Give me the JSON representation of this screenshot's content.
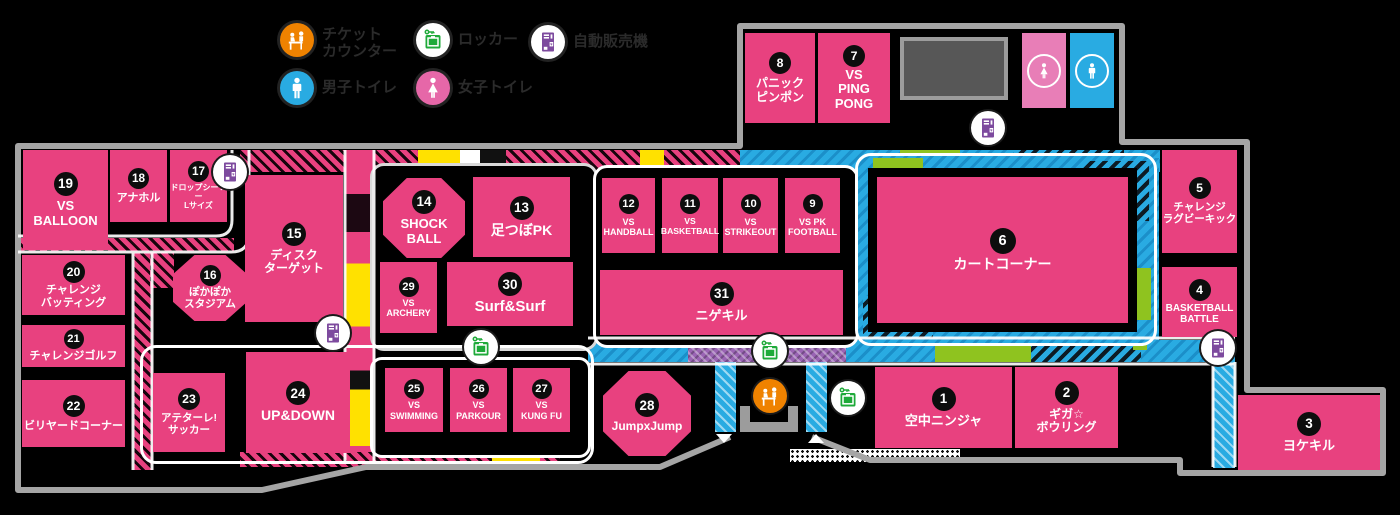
{
  "legend": {
    "items": [
      {
        "icon": "ticket-counter-icon",
        "label": "チケット\nカウンター",
        "color": "#ef8200"
      },
      {
        "icon": "locker-icon",
        "label": "ロッカー",
        "color": "#1eaa39"
      },
      {
        "icon": "vending-machine-icon",
        "label": "自動販売機",
        "color": "#7d4a9e"
      },
      {
        "icon": "mens-toilet-icon",
        "label": "男子トイレ",
        "color": "#29abe2"
      },
      {
        "icon": "womens-toilet-icon",
        "label": "女子トイレ",
        "color": "#e667a8"
      }
    ]
  },
  "attractions": [
    {
      "num": "1",
      "label": "空中ニンジャ"
    },
    {
      "num": "2",
      "label": "ギガ☆\nボウリング"
    },
    {
      "num": "3",
      "label": "ヨケキル"
    },
    {
      "num": "4",
      "label": "BASKETBALL\nBATTLE"
    },
    {
      "num": "5",
      "label": "チャレンジ\nラグビーキック"
    },
    {
      "num": "6",
      "label": "カートコーナー"
    },
    {
      "num": "7",
      "label": "VS\nPING\nPONG"
    },
    {
      "num": "8",
      "label": "パニック\nピンポン"
    },
    {
      "num": "9",
      "label": "VS PK\nFOOTBALL"
    },
    {
      "num": "10",
      "label": "VS\nSTRIKEOUT"
    },
    {
      "num": "11",
      "label": "VS\nBASKETBALL"
    },
    {
      "num": "12",
      "label": "VS\nHANDBALL"
    },
    {
      "num": "13",
      "label": "足つぼPK"
    },
    {
      "num": "14",
      "label": "SHOCK\nBALL"
    },
    {
      "num": "15",
      "label": "ディスク\nターゲット"
    },
    {
      "num": "16",
      "label": "ぽかぽか\nスタジアム"
    },
    {
      "num": "17",
      "label": "ドロップシーソー\nLサイズ"
    },
    {
      "num": "18",
      "label": "アナホル"
    },
    {
      "num": "19",
      "label": "VS\nBALLOON"
    },
    {
      "num": "20",
      "label": "チャレンジ\nバッティング"
    },
    {
      "num": "21",
      "label": "チャレンジゴルフ"
    },
    {
      "num": "22",
      "label": "ビリヤードコーナー"
    },
    {
      "num": "23",
      "label": "アテターレ!\nサッカー"
    },
    {
      "num": "24",
      "label": "UP&DOWN"
    },
    {
      "num": "25",
      "label": "VS\nSWIMMING"
    },
    {
      "num": "26",
      "label": "VS\nPARKOUR"
    },
    {
      "num": "27",
      "label": "VS\nKUNG FU"
    },
    {
      "num": "28",
      "label": "JumpxJump"
    },
    {
      "num": "29",
      "label": "VS\nARCHERY"
    },
    {
      "num": "30",
      "label": "Surf&Surf"
    },
    {
      "num": "31",
      "label": "ニゲキル"
    }
  ],
  "colors": {
    "box_pink": "#e8417f",
    "path_cyan": "#29abe2",
    "accent_yellow": "#ffe100",
    "accent_green": "#8fc31f",
    "vending_purple": "#7d4a9e",
    "ticket_orange": "#ef8200",
    "locker_green": "#1eaa39",
    "toilet_pink": "#e87eb7",
    "border_gray": "#a5a5a5"
  }
}
